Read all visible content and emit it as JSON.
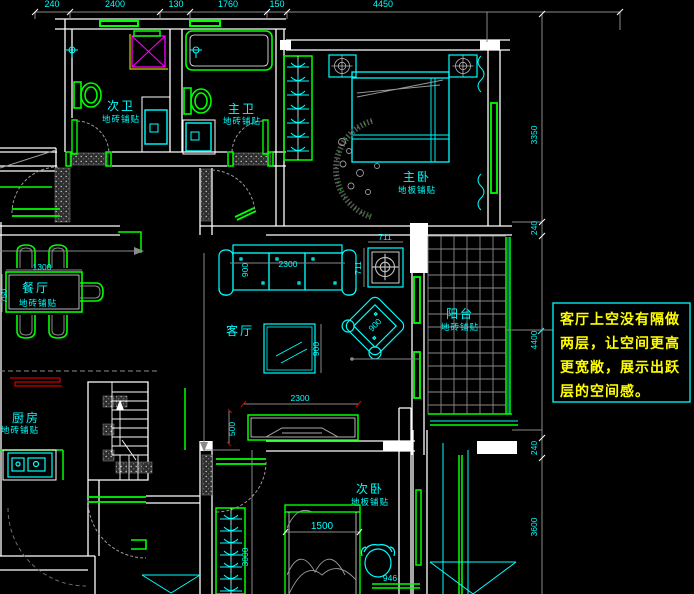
{
  "drawing": {
    "type": "CAD residential floor plan",
    "background": "#000000"
  },
  "colors": {
    "walls": "#ffffff",
    "fixtures": "#00ff00",
    "furniture": "#00ffff",
    "shower": "#ff00ff",
    "annotation_text": "#ffff00",
    "dimension_lines": "#8a8a8a",
    "kitchen_counter_lines": "#ff0000"
  },
  "rooms": [
    {
      "name": "次卫",
      "finish": "地砖铺贴"
    },
    {
      "name": "主卫",
      "finish": "地砖铺贴"
    },
    {
      "name": "主卧",
      "finish": "地板铺贴"
    },
    {
      "name": "餐厅",
      "finish": "地砖铺贴"
    },
    {
      "name": "客厅",
      "finish": ""
    },
    {
      "name": "阳台",
      "finish": "地砖铺贴"
    },
    {
      "name": "厨房",
      "finish": "地砖铺贴"
    },
    {
      "name": "次卧",
      "finish": "地板铺贴"
    }
  ],
  "annotation": {
    "lines": [
      "客厅上空没有隔做",
      "两层，让空间更高",
      "更宽敞，展示出跃",
      "层的空间感。"
    ]
  },
  "dimensions": {
    "top": [
      "240",
      "2400",
      "130",
      "1760",
      "150",
      "4450"
    ],
    "right": [
      "3350",
      "240",
      "4400",
      "240",
      "3600"
    ],
    "interior": {
      "sofa_width": "2300",
      "sofa_depth": "900",
      "unit_w": "711",
      "unit_h": "711",
      "coffee_table": "900",
      "armchair": "900",
      "tv_wall": "2300",
      "dining_width": "1300",
      "dining_depth": "750",
      "cabinet": "500",
      "bed": "1500",
      "bed_side": "946",
      "bedroom_depth": "3000"
    }
  }
}
